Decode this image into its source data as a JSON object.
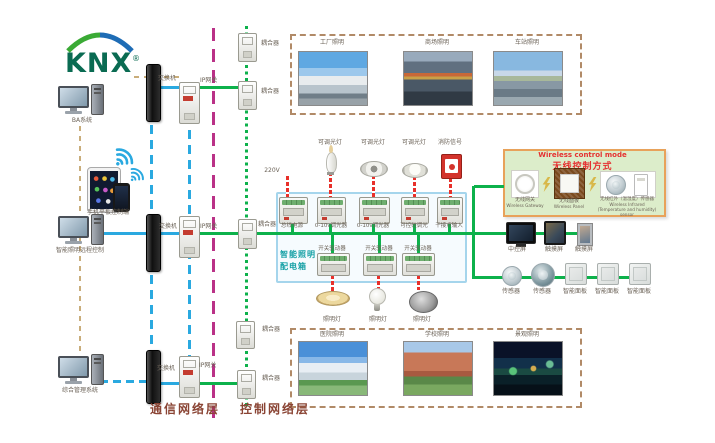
{
  "logo": {
    "text": "KNX",
    "registered": "®"
  },
  "clients": {
    "ba_system": "BA系统",
    "mobile": "手机平板控制端",
    "remote_control": "智能照明远程控制",
    "management": "综合管理系统"
  },
  "network": {
    "switch": "交换机",
    "gateway": "IP网关",
    "coupler": "耦合器"
  },
  "layers": {
    "communication": "通信网络层",
    "control": "控制网络层"
  },
  "cabinet": {
    "title_line1": "智能照明",
    "title_line2": "配电箱",
    "power": "220V",
    "top_devices": [
      "可调光灯",
      "可调光灯",
      "可调光灯",
      "消防信号"
    ],
    "top_modules": [
      "总线电源",
      "0-10v调光器",
      "0-10v调光器",
      "可控硅调光",
      "干接点输入"
    ],
    "drivers": [
      "开关驱动器",
      "开关驱动器",
      "开关驱动器"
    ],
    "lamps": [
      "照明灯",
      "照明灯",
      "照明灯"
    ]
  },
  "wireless": {
    "title_en": "Wireless control mode",
    "title_zh": "无线控制方式",
    "devices": [
      {
        "zh": "无线网关",
        "en": "Wireless Gateway"
      },
      {
        "zh": "无线面板",
        "en": "Wireless Panel"
      },
      {
        "zh": "无线红外（温湿度）传感器",
        "en": "Wireless Infrared (Temperature and humidity) sensor"
      }
    ]
  },
  "terminals": {
    "screens": [
      "中控屏",
      "触摸屏",
      "触摸屏"
    ],
    "sensors": [
      "传感器",
      "传感器"
    ],
    "panels": [
      "智能面板",
      "智能面板",
      "智能面板"
    ]
  },
  "applications": {
    "top": [
      "工厂照明",
      "商场照明",
      "车站照明"
    ],
    "bottom": [
      "医院照明",
      "学校照明",
      "景观照明"
    ]
  },
  "colors": {
    "bus_green": "#0db14b",
    "ethernet_blue": "#2aa9e0",
    "layer_divider_magenta": "#ba3187",
    "power_red": "#e8302a",
    "system_tan": "#c9ad7a",
    "cabinet_teal": "#15a0a5",
    "layer_label_brown": "#8a4434",
    "wireless_title_red": "#e53030"
  }
}
